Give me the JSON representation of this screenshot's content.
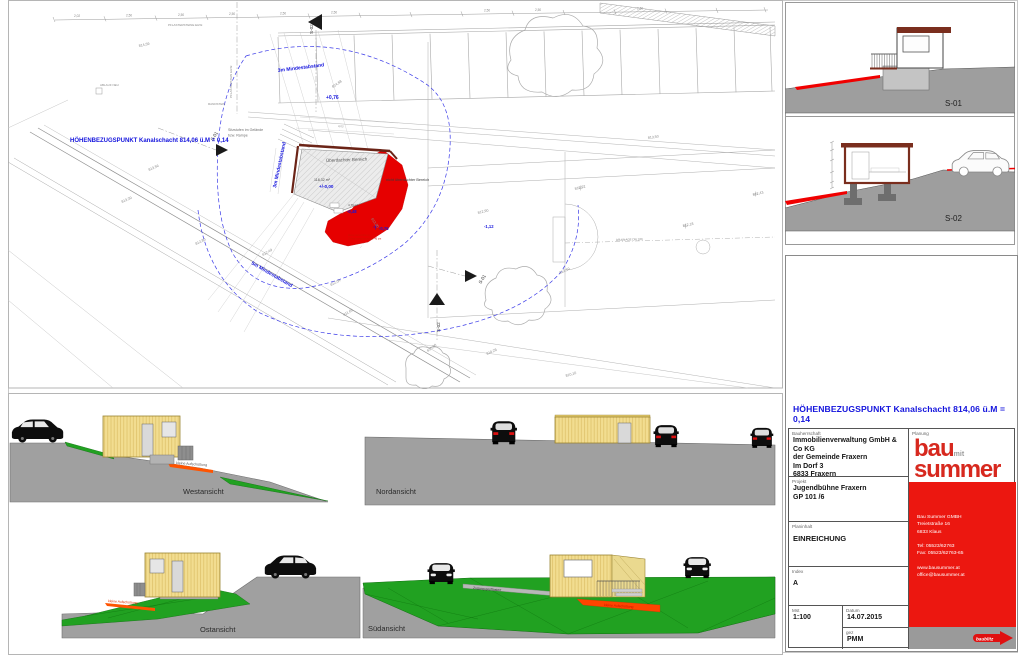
{
  "site_plan": {
    "datum_note": "HÖHENBEZUGSPUNKT  Kanalschacht 814,06 ü.M = 0,14",
    "setback_3m_top": "3m Mindestabstand",
    "setback_3m_left": "3m Mindestabstand",
    "setback_5m": "5m Mindestabstand",
    "covered_label": "Überdachter Bereich",
    "uncovered_label": "nicht überdachter Bereich",
    "seat_steps_line1": "Sitzstufen im Gelände",
    "seat_steps_line2": "bzw. Rampe",
    "paving_label": "PFLASTERSTEINE EHW.",
    "paving_label_vertical": "PFLASTERSTEIN EHW.",
    "drain_label": "ABLAUF NEU",
    "curb_label": "RANDSTEIN",
    "drainage_label": "DRAINAGE DN 160",
    "fill_note_line1": "kleine Aufschüttung",
    "fill_note_line2": "Geländeanpassung ca. 40 cm",
    "area_main": "118,32 m²",
    "area_small": "4,79 m²",
    "level_plus": "+0,76",
    "level_zero": "+/-0,00",
    "level_m048": "-0,48",
    "level_m076": "-0,76",
    "level_m112": "-1,12",
    "dim_a": "2,02",
    "dim_b": "2,50",
    "dim_c": "4,03",
    "marker_s01": "S-01",
    "marker_s02": "S-02",
    "contours": [
      "814,68",
      "814,59",
      "813,56",
      "813,50",
      "813,39",
      "813,00",
      "812,92",
      "812,90",
      "812,80",
      "812,49",
      "812,43",
      "812,18",
      "812,10",
      "812,04",
      "811,62",
      "810,90",
      "810,28",
      "810,10"
    ]
  },
  "elevations": {
    "west": {
      "label": "Westansicht",
      "note": "kleine Aufschüttung"
    },
    "north": {
      "label": "Nordansicht"
    },
    "east": {
      "label": "Ostansicht",
      "note": "kleine Aufschüttung"
    },
    "south": {
      "label": "Südansicht",
      "path_note": "Zugang gepflastert",
      "note": "kleine Aufschüttung"
    }
  },
  "sections": {
    "s01_label": "S-01",
    "s02_label": "S-02"
  },
  "title_block": {
    "datum_note": "HÖHENBEZUGSPUNKT  Kanalschacht 814,06 ü.M = 0,14",
    "client_label": "Bauherrschaft",
    "client_lines": [
      "Immobilienverwaltung GmbH & Co KG",
      "der Gemeinde Fraxern",
      "Im Dorf 3",
      "6833 Fraxern"
    ],
    "project_label": "Projekt",
    "project_lines": [
      "Jugendbühne Fraxern",
      "GP  101 /6"
    ],
    "content_label": "Planinhalt",
    "content_value": "EINREICHUNG",
    "index_label": "Index",
    "index_value": "A",
    "scale_label": "Mst",
    "scale_value": "1:100",
    "date_label": "Datum",
    "date_value": "14.07.2015",
    "drawn_label": "gez",
    "drawn_value": "PMM",
    "planning_label": "Planung",
    "logo": {
      "bau": "bau",
      "mit": "mit",
      "summer": "summer",
      "tagline": "baublitz"
    },
    "company_lines": [
      "Bau Summer GMBH",
      "Treietstraße 16",
      "6833 Klaus",
      "",
      "Tel:   05523/62763",
      "Fax:  05523/62763-65",
      "",
      "www.bausummer.at",
      "office@bausummer.at"
    ]
  }
}
